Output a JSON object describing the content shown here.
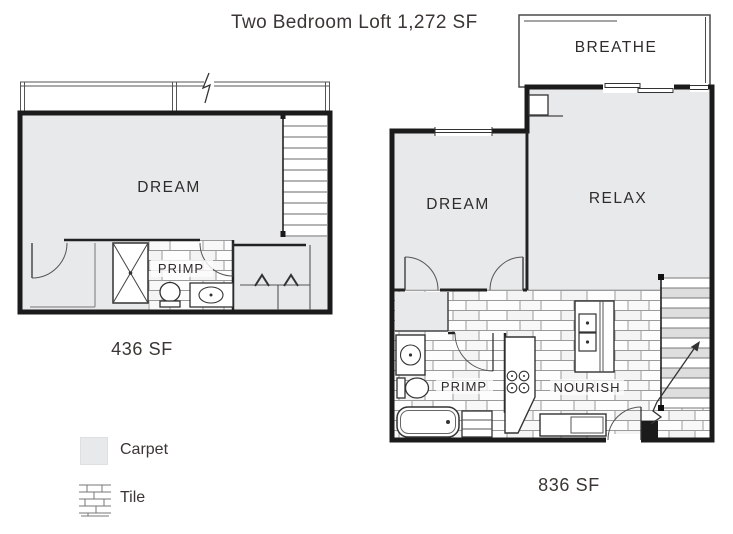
{
  "title": "Two Bedroom Loft 1,272 SF",
  "upper_floor": {
    "rooms": {
      "dream": "DREAM",
      "primp": "PRIMP"
    },
    "area_label": "436 SF"
  },
  "main_floor": {
    "rooms": {
      "breathe": "BREATHE",
      "dream": "DREAM",
      "relax": "RELAX",
      "primp": "PRIMP",
      "nourish": "NOURISH"
    },
    "area_label": "836 SF"
  },
  "legend": {
    "carpet_label": "Carpet",
    "tile_label": "Tile"
  },
  "colors": {
    "carpet": "#e8e9eb",
    "wall": "#1b1b1b",
    "tile_line": "#9b9b9b",
    "text": "#3b3633"
  }
}
